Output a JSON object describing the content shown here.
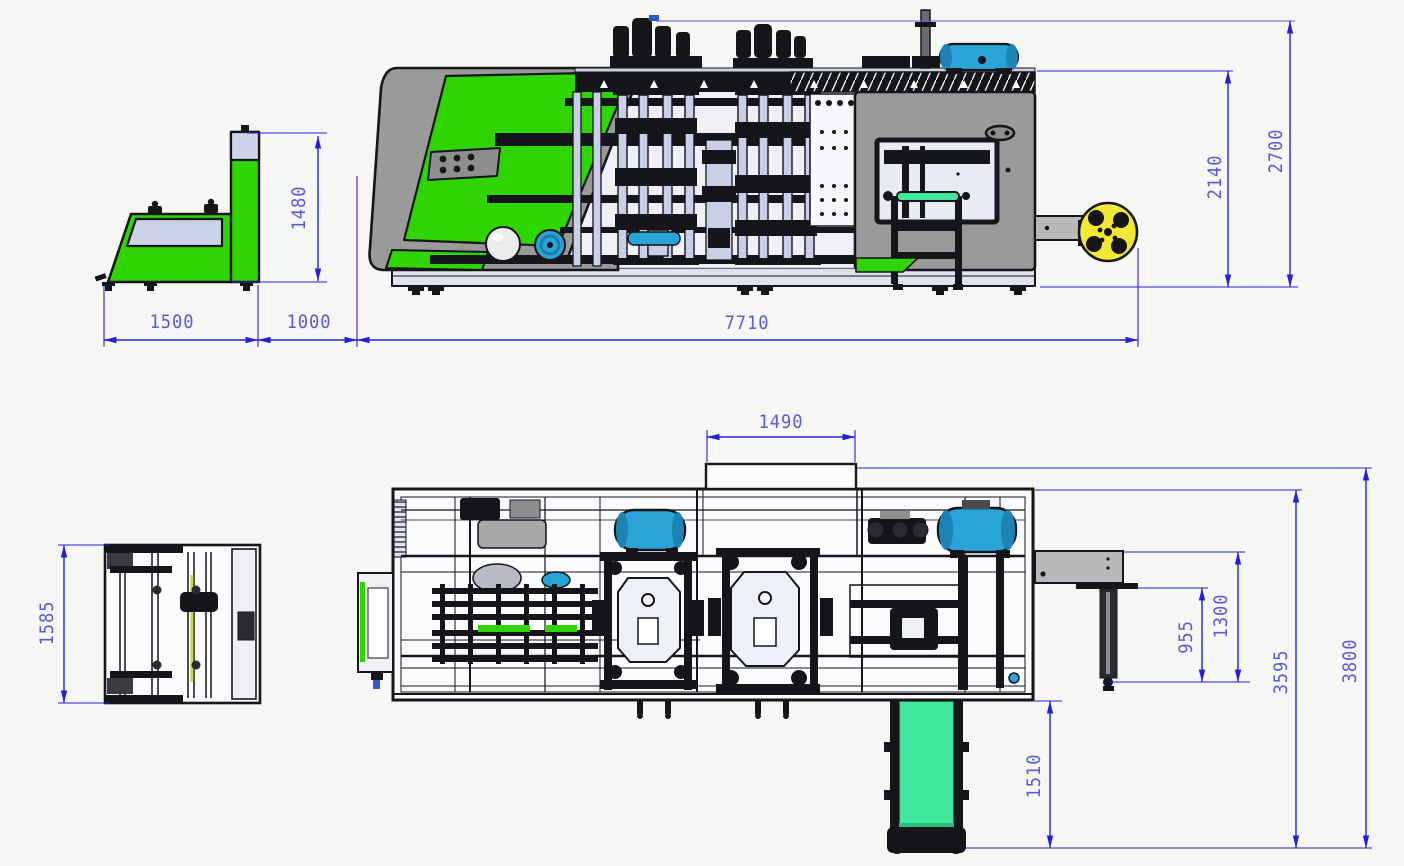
{
  "drawing": {
    "kind": "engineering-three-view-drawing",
    "subject": "thermoforming machine line general arrangement with dimensions"
  },
  "dims": {
    "d1480": "1480",
    "d1500": "1500",
    "d1000": "1000",
    "d7710": "7710",
    "d2140": "2140",
    "d2700": "2700",
    "d1490": "1490",
    "d1585": "1585",
    "d955": "955",
    "d1300": "1300",
    "d1510": "1510",
    "d3595": "3595",
    "d3800": "3800"
  },
  "colors": {
    "dimension_line": "#2020dd",
    "dimension_text": "#5b5bd8",
    "machine_green": "#2ed500",
    "conveyor_green": "#3fe89c",
    "tank_blue": "#2aa3d6",
    "reel_yellow": "#f2e833",
    "body_gray": "#9a9a9a",
    "panel_lavender": "#c8cfe6",
    "outline": "#15151a",
    "background": "#f6f6f4"
  }
}
